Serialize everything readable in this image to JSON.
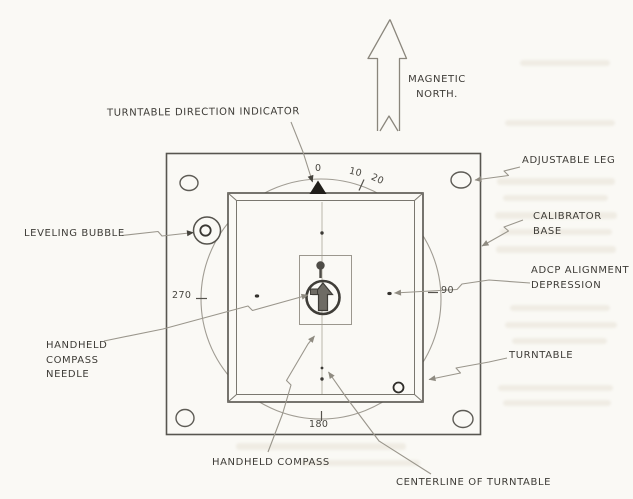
{
  "colors": {
    "paper": "#faf9f5",
    "pencil_dark": "#55534d",
    "pencil_light": "#9a968c",
    "indicator_fill": "#201e1a",
    "needle_fill": "#6e6b64",
    "bleed_through": "#d8d0bd"
  },
  "diagram": {
    "callouts": {
      "turntable_direction_indicator": "TURNTABLE DIRECTION INDICATOR",
      "magnetic_north": "MAGNETIC\nNORTH.",
      "adjustable_leg": "ADJUSTABLE LEG",
      "calibrator_base": "CALIBRATOR BASE",
      "adcp_alignment_depression": "ADCP ALIGNMENT\nDEPRESSION",
      "turntable": "TURNTABLE",
      "leveling_bubble": "LEVELING BUBBLE",
      "handheld_compass_needle": "HANDHELD\nCOMPASS\nNEEDLE",
      "handheld_compass": "HANDHELD COMPASS",
      "centerline_of_turntable": "CENTERLINE OF TURNTABLE"
    },
    "dial_marks": {
      "d0": "0",
      "d10": "10",
      "d20": "20",
      "d90": "90",
      "d180": "180",
      "d270": "270"
    }
  }
}
